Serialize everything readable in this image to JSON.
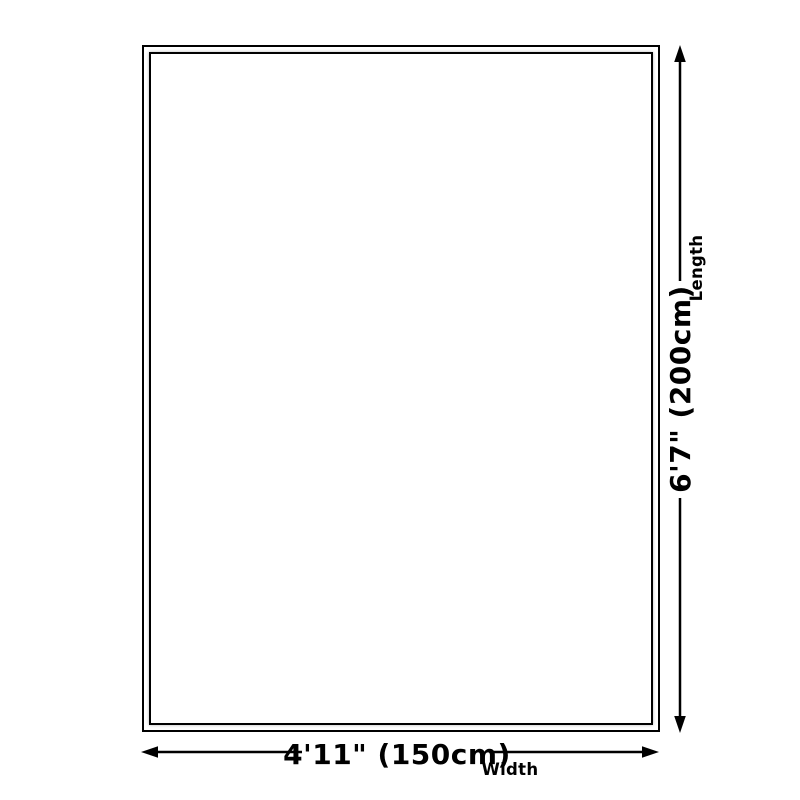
{
  "diagram": {
    "type": "product-dimension-diagram",
    "width_dimension": {
      "value": "4'11\" (150cm)",
      "label": "Width"
    },
    "length_dimension": {
      "value": "6'7\" (200cm)",
      "label": "Length"
    },
    "colors": {
      "line": "#000000",
      "background": "#ffffff"
    }
  }
}
